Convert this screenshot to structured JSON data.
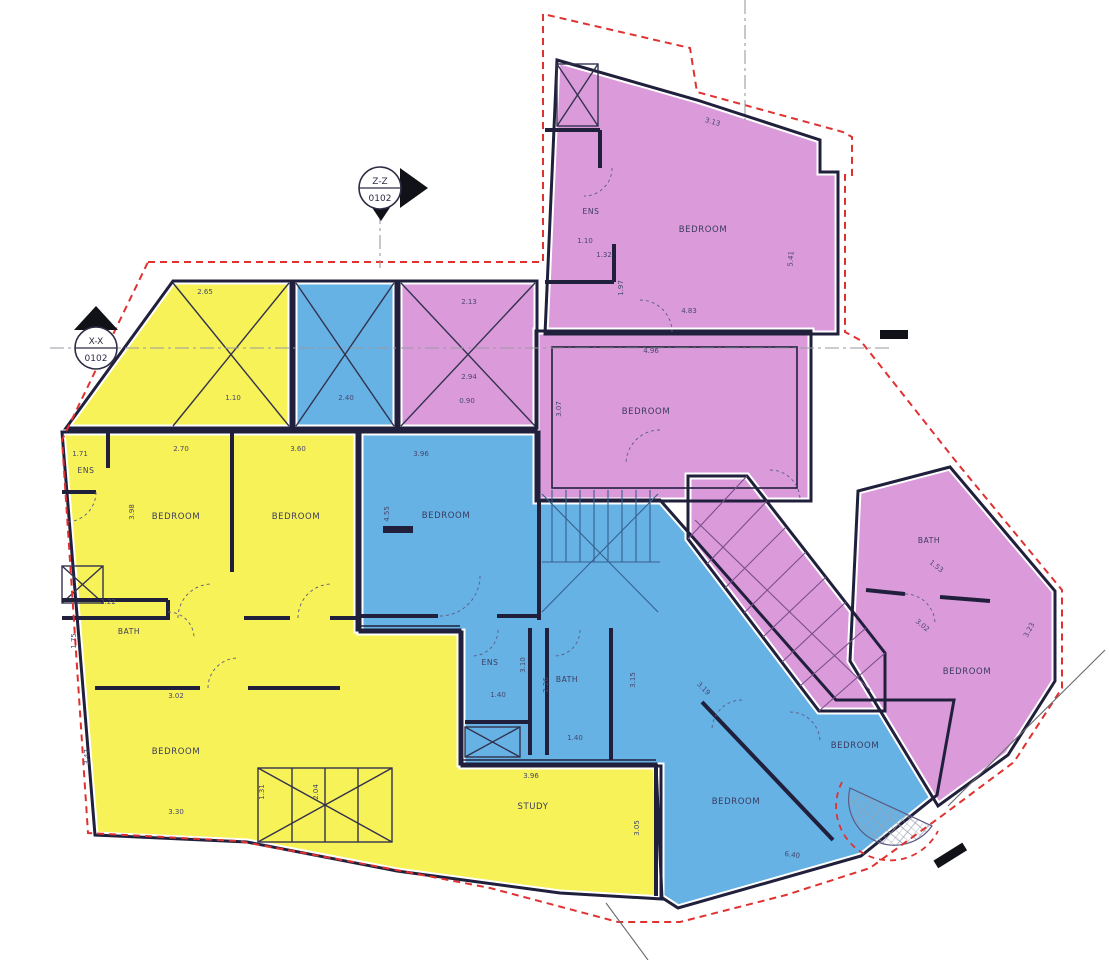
{
  "section_markers": {
    "zz": {
      "name": "Z-Z",
      "sheet": "0102"
    },
    "xx": {
      "name": "X-X",
      "sheet": "0102"
    }
  },
  "colors": {
    "unit_yellow": "#f7f257",
    "unit_blue": "#66b2e4",
    "unit_pink": "#db9bdb",
    "wall": "#20203c",
    "boundary_red": "#e03131",
    "centerline_gray": "#9a9aa2",
    "dim_text": "#47476e"
  },
  "room_labels": [
    {
      "text": "ENS",
      "x": 86,
      "y": 473,
      "unit": "yellow",
      "size": 7.5
    },
    {
      "text": "BEDROOM",
      "x": 176,
      "y": 519,
      "unit": "yellow"
    },
    {
      "text": "BEDROOM",
      "x": 296,
      "y": 519,
      "unit": "yellow"
    },
    {
      "text": "BATH",
      "x": 129,
      "y": 634,
      "unit": "yellow",
      "size": 7.5
    },
    {
      "text": "BEDROOM",
      "x": 176,
      "y": 754,
      "unit": "yellow"
    },
    {
      "text": "STUDY",
      "x": 533,
      "y": 809,
      "unit": "yellow"
    },
    {
      "text": "BEDROOM",
      "x": 446,
      "y": 518,
      "unit": "blue"
    },
    {
      "text": "ENS",
      "x": 490,
      "y": 665,
      "unit": "blue",
      "size": 7.5
    },
    {
      "text": "BATH",
      "x": 567,
      "y": 682,
      "unit": "blue",
      "size": 7.5
    },
    {
      "text": "BEDROOM",
      "x": 736,
      "y": 804,
      "unit": "blue"
    },
    {
      "text": "BEDROOM",
      "x": 855,
      "y": 748,
      "unit": "blue"
    },
    {
      "text": "ENS",
      "x": 591,
      "y": 214,
      "unit": "pink",
      "size": 7.5
    },
    {
      "text": "BEDROOM",
      "x": 703,
      "y": 232,
      "unit": "pink"
    },
    {
      "text": "BEDROOM",
      "x": 646,
      "y": 414,
      "unit": "pink"
    },
    {
      "text": "BATH",
      "x": 929,
      "y": 543,
      "unit": "pink",
      "size": 7.5
    },
    {
      "text": "BEDROOM",
      "x": 967,
      "y": 674,
      "unit": "pink"
    }
  ],
  "dimension_labels": [
    {
      "text": "2.65",
      "x": 205,
      "y": 294
    },
    {
      "text": "1.10",
      "x": 233,
      "y": 400
    },
    {
      "text": "2.40",
      "x": 346,
      "y": 400
    },
    {
      "text": "2.13",
      "x": 469,
      "y": 304
    },
    {
      "text": "2.94",
      "x": 469,
      "y": 379
    },
    {
      "text": "0.90",
      "x": 467,
      "y": 403
    },
    {
      "text": "1.71",
      "x": 80,
      "y": 456
    },
    {
      "text": "2.70",
      "x": 181,
      "y": 451
    },
    {
      "text": "3.60",
      "x": 298,
      "y": 451
    },
    {
      "text": "3.96",
      "x": 421,
      "y": 456
    },
    {
      "text": "3.98",
      "x": 134,
      "y": 512,
      "rot": -90
    },
    {
      "text": "4.55",
      "x": 389,
      "y": 514,
      "rot": -90
    },
    {
      "text": "2.22",
      "x": 108,
      "y": 604
    },
    {
      "text": "1.75",
      "x": 76,
      "y": 641,
      "rot": -90
    },
    {
      "text": "3.02",
      "x": 176,
      "y": 698
    },
    {
      "text": "3.47",
      "x": 89,
      "y": 757,
      "rot": -90
    },
    {
      "text": "3.30",
      "x": 176,
      "y": 814
    },
    {
      "text": "1.31",
      "x": 264,
      "y": 792,
      "rot": -90
    },
    {
      "text": "2.04",
      "x": 318,
      "y": 792,
      "rot": -90
    },
    {
      "text": "3.96",
      "x": 531,
      "y": 778
    },
    {
      "text": "3.05",
      "x": 639,
      "y": 828,
      "rot": -90
    },
    {
      "text": "1.40",
      "x": 498,
      "y": 697
    },
    {
      "text": "3.10",
      "x": 525,
      "y": 665,
      "rot": -90
    },
    {
      "text": "2.26",
      "x": 548,
      "y": 685,
      "rot": -90
    },
    {
      "text": "1.40",
      "x": 575,
      "y": 740
    },
    {
      "text": "3.15",
      "x": 635,
      "y": 680,
      "rot": -90
    },
    {
      "text": "3.19",
      "x": 702,
      "y": 690,
      "rot": 45
    },
    {
      "text": "6.40",
      "x": 792,
      "y": 857,
      "rot": 8
    },
    {
      "text": "1.10",
      "x": 585,
      "y": 243
    },
    {
      "text": "1.32",
      "x": 604,
      "y": 257
    },
    {
      "text": "1.97",
      "x": 623,
      "y": 288,
      "rot": -90
    },
    {
      "text": "3.13",
      "x": 712,
      "y": 124,
      "rot": 16
    },
    {
      "text": "5.41",
      "x": 793,
      "y": 259,
      "rot": -85
    },
    {
      "text": "4.83",
      "x": 689,
      "y": 313
    },
    {
      "text": "4.96",
      "x": 651,
      "y": 353
    },
    {
      "text": "3.07",
      "x": 561,
      "y": 409,
      "rot": -90
    },
    {
      "text": "1.53",
      "x": 935,
      "y": 568,
      "rot": 38
    },
    {
      "text": "3.02",
      "x": 921,
      "y": 627,
      "rot": 40
    },
    {
      "text": "3.23",
      "x": 1031,
      "y": 631,
      "rot": -62
    }
  ]
}
